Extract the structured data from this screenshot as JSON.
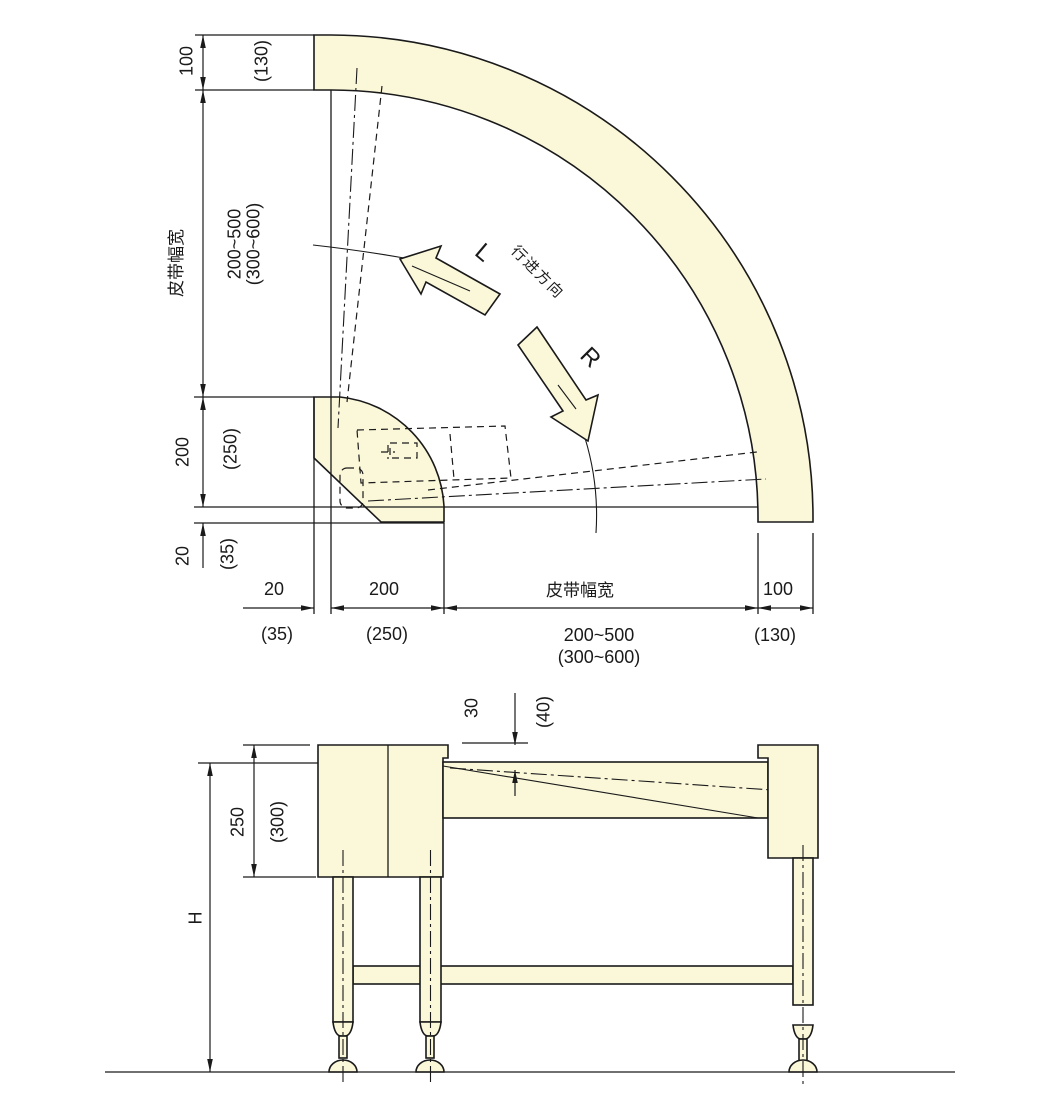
{
  "colors": {
    "part_fill": "#FBF8DA",
    "line": "#1A1A1A",
    "background": "#FFFFFF"
  },
  "plan": {
    "left_dims": {
      "d100": "100",
      "d130": "(130)",
      "belt_label": "皮带幅宽",
      "range": "200~500",
      "range_alt": "(300~600)",
      "d200": "200",
      "d250": "(250)",
      "d20": "20",
      "d35": "(35)"
    },
    "bottom_dims": {
      "d20": "20",
      "d35": "(35)",
      "d200": "200",
      "d250": "(250)",
      "belt_label": "皮带幅宽",
      "range": "200~500",
      "range_alt": "(300~600)",
      "d100": "100",
      "d130": "(130)"
    },
    "marks": {
      "left": "L",
      "right": "R",
      "direction": "行进方向"
    }
  },
  "side": {
    "dims": {
      "d30": "30",
      "d40": "(40)",
      "d250": "250",
      "d300": "(300)",
      "height": "H"
    }
  }
}
